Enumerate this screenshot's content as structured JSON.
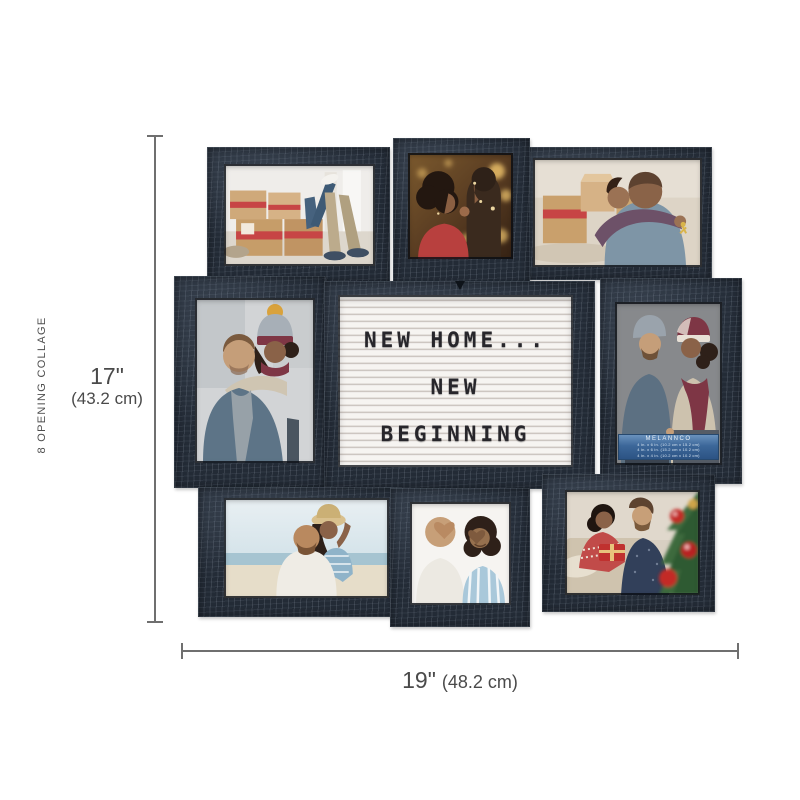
{
  "annotations": {
    "side_label": "8 OPENING COLLAGE",
    "height_dim": {
      "imperial": "17\"",
      "metric": "(43.2 cm)"
    },
    "width_dim": {
      "imperial": "19\"",
      "metric": "(48.2 cm)"
    }
  },
  "letterboard": {
    "lines": [
      "NEW HOME...",
      "NEW",
      "BEGINNING"
    ]
  },
  "insert_label": {
    "brand": "MELANNCO",
    "sizes": [
      "4 in. x 6 in. (10.2 cm x 15.2 cm)",
      "4 in. x 6 in. (15.2 cm x 10.2 cm)",
      "4 in. x 4 in. (10.2 cm x 10.2 cm)"
    ]
  },
  "photos": {
    "top_left": "couple-moving-day-boxes",
    "top_center": "couple-christmas-bokeh",
    "top_right": "couple-hug-with-keys",
    "middle_left": "couple-piggyback-winter",
    "middle_right": "couple-back-to-back",
    "bottom_left": "couple-piggyback-beach",
    "bottom_center": "couple-heart-hands",
    "bottom_right": "couple-christmas-gifts"
  },
  "colors": {
    "frame": "#232b36",
    "board_surface": "#f2efec",
    "insert_blue": "#3c6799",
    "dimension_text": "#4a4a4a",
    "background": "#ffffff"
  }
}
